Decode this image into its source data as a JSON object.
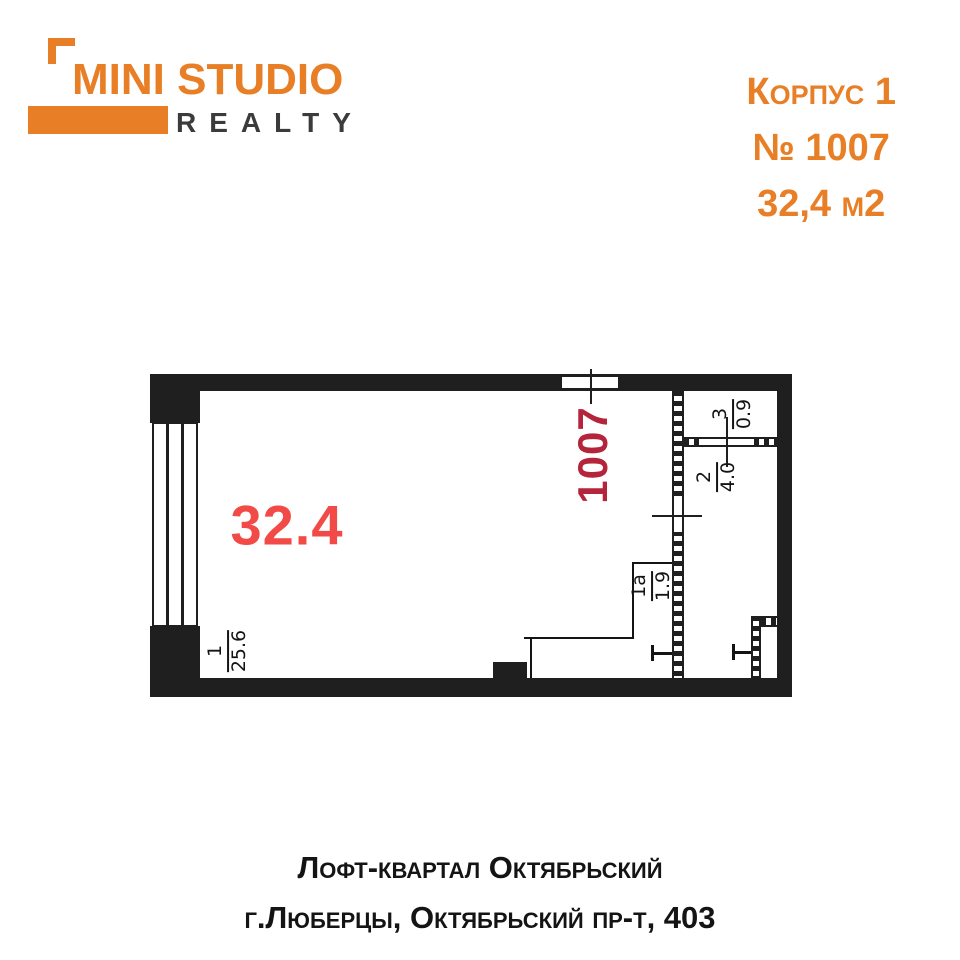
{
  "colors": {
    "accent": "#E87E25",
    "gray_dark": "#3B3B3B",
    "wall": "#1F1F1F",
    "ink": "#141414",
    "red": "#F24A46",
    "dark_red": "#B4243A"
  },
  "brand": {
    "title": "MINI STUDIO",
    "subtitle": "REALTY"
  },
  "listing": {
    "building": "Корпус 1",
    "unit": "№ 1007",
    "area": "32,4 м2"
  },
  "floorplan": {
    "apartment_number": "1007",
    "total_area_label": "32.4",
    "rooms": [
      {
        "number": "1",
        "area": "25.6"
      },
      {
        "number": "1а",
        "area": "1.9"
      },
      {
        "number": "2",
        "area": "4.0"
      },
      {
        "number": "3",
        "area": "0.9"
      }
    ]
  },
  "footer": {
    "line1": "Лофт-квартал Октябрьский",
    "line2": "г.Люберцы, Октябрьский пр-т, 403"
  }
}
